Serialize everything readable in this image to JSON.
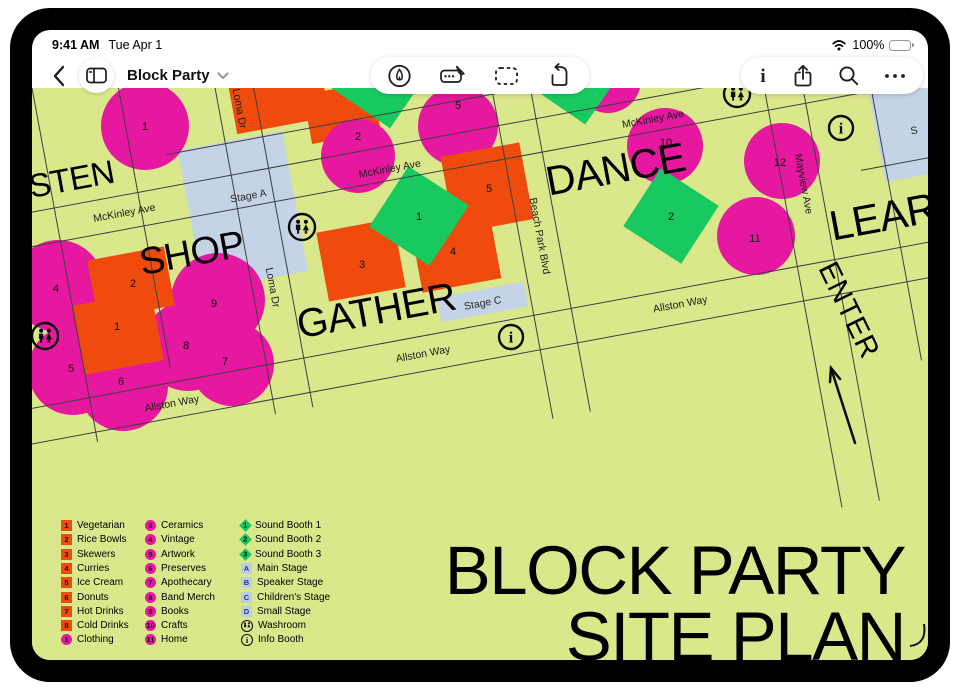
{
  "status": {
    "time": "9:41 AM",
    "date": "Tue Apr 1",
    "battery": "100%",
    "icons": [
      "wifi-icon",
      "battery-icon"
    ]
  },
  "toolbar": {
    "title": "Block Party",
    "icons": {
      "left": [
        "back",
        "sidebar"
      ],
      "center": [
        "pencil-tool",
        "handwriting-tool",
        "selection-tool",
        "rotate-tool"
      ],
      "right": [
        "info",
        "share",
        "search",
        "more"
      ]
    }
  },
  "map": {
    "zones": {
      "listen": "LISTEN",
      "shop": "SHOP",
      "gather": "GATHER",
      "dance": "DANCE",
      "learn": "LEARN",
      "enter": "ENTER"
    },
    "streets": {
      "mckinley": "McKinley Ave",
      "loma": "Loma Dr",
      "beach": "Beach Park Blvd",
      "allston": "Allston Way",
      "mayview": "Mayview Ave"
    },
    "stages": {
      "a": "Stage A",
      "c": "Stage C",
      "partial": "S"
    },
    "icons": {
      "info_glyph": "i"
    },
    "nums": {
      "circle_listen1": "1",
      "circle_top2": "2",
      "circle_top5": "5",
      "circle_shop4": "4",
      "circle_shop5": "5",
      "circle_shop6": "6",
      "circle_shop7": "7",
      "circle_shop8": "8",
      "circle_shop9": "9",
      "circle_dance10": "10",
      "circle_dance11": "11",
      "circle_dance12": "12",
      "square_shop1": "1",
      "square_shop2": "2",
      "square_gather3": "3",
      "square_gather4": "4",
      "square_gather5": "5",
      "diamond_gather": "1",
      "diamond_dance": "2"
    }
  },
  "legend": {
    "col1": [
      {
        "badge": "1",
        "label": "Vegetarian"
      },
      {
        "badge": "2",
        "label": "Rice Bowls"
      },
      {
        "badge": "3",
        "label": "Skewers"
      },
      {
        "badge": "4",
        "label": "Curries"
      },
      {
        "badge": "5",
        "label": "Ice Cream"
      },
      {
        "badge": "6",
        "label": "Donuts"
      },
      {
        "badge": "7",
        "label": "Hot Drinks"
      },
      {
        "badge": "8",
        "label": "Cold Drinks"
      },
      {
        "badge": "1",
        "label": "Clothing"
      }
    ],
    "col2": [
      {
        "badge": "3",
        "label": "Ceramics"
      },
      {
        "badge": "4",
        "label": "Vintage"
      },
      {
        "badge": "5",
        "label": "Artwork"
      },
      {
        "badge": "6",
        "label": "Preserves"
      },
      {
        "badge": "7",
        "label": "Apothecary"
      },
      {
        "badge": "8",
        "label": "Band Merch"
      },
      {
        "badge": "9",
        "label": "Books"
      },
      {
        "badge": "10",
        "label": "Crafts"
      },
      {
        "badge": "11",
        "label": "Home"
      }
    ],
    "col3": [
      {
        "badge": "1",
        "label": "Sound Booth 1"
      },
      {
        "badge": "2",
        "label": "Sound Booth 2"
      },
      {
        "badge": "3",
        "label": "Sound Booth 3"
      },
      {
        "badge": "A",
        "label": "Main Stage"
      },
      {
        "badge": "B",
        "label": "Speaker Stage"
      },
      {
        "badge": "C",
        "label": "Children's Stage"
      },
      {
        "badge": "D",
        "label": "Small Stage"
      },
      {
        "badge": "",
        "label": "Washroom"
      },
      {
        "badge": "i",
        "label": "Info Booth"
      }
    ]
  },
  "poster": {
    "line1": "BLOCK PARTY",
    "line2": "SITE PLAN"
  },
  "colors": {
    "canvas": "#dbe78b",
    "magenta": "#e5189f",
    "orange": "#ee4b0d",
    "green": "#17c95f",
    "stage_blue": "#c5d3e6"
  }
}
